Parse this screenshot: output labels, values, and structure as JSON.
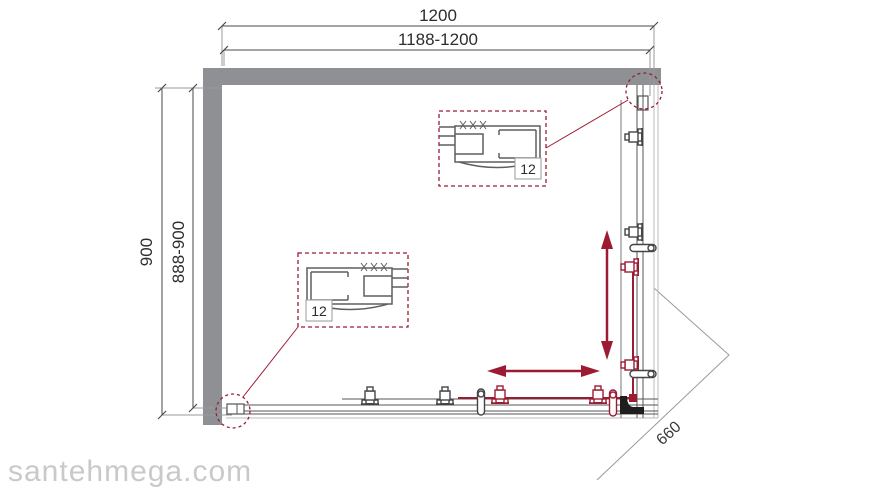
{
  "drawing": {
    "title": "shower-enclosure-installation-diagram",
    "dimensions": {
      "width_nominal": "1200",
      "width_range": "1188-1200",
      "height_nominal": "900",
      "height_range": "888-900",
      "diagonal_entry": "660"
    },
    "details": {
      "top": {
        "label": "12"
      },
      "bottom": {
        "label": "12"
      }
    },
    "watermark": "santehmega.com",
    "colors": {
      "accent": "#9c1b33",
      "wall": "#8f9094",
      "line_dark": "#4a4a4a",
      "line_light": "#aaaaaa",
      "watermark": "#c9c9c9"
    }
  }
}
